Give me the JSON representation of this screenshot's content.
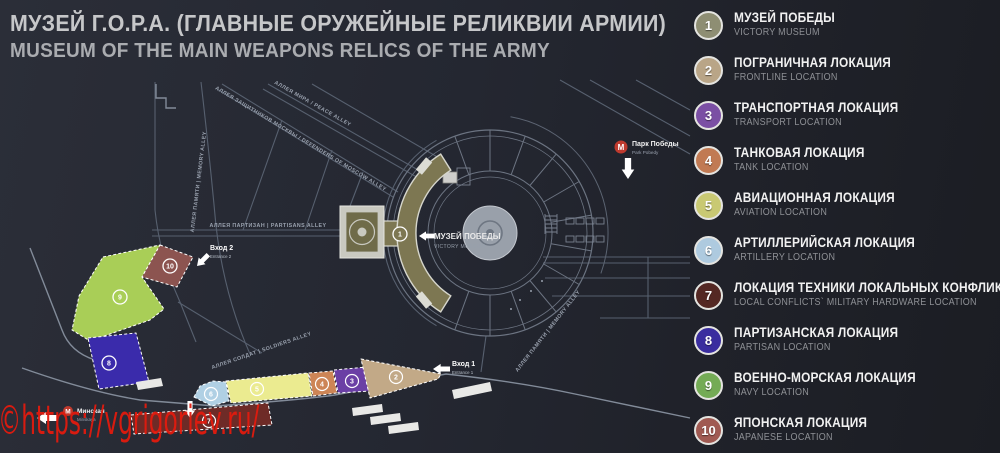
{
  "header": {
    "title_ru": "МУЗЕЙ Г.О.Р.А. (ГЛАВНЫЕ ОРУЖЕЙНЫЕ РЕЛИКВИИ АРМИИ)",
    "title_en": "MUSEUM OF THE MAIN WEAPONS RELICS OF THE ARMY"
  },
  "legend": {
    "items": [
      {
        "num": "1",
        "ru": "МУЗЕЙ ПОБЕДЫ",
        "en": "VICTORY MUSEUM",
        "color": "#8e8e73"
      },
      {
        "num": "2",
        "ru": "ПОГРАНИЧНАЯ ЛОКАЦИЯ",
        "en": "FRONTLINE LOCATION",
        "color": "#b9a587"
      },
      {
        "num": "3",
        "ru": "ТРАНСПОРТНАЯ ЛОКАЦИЯ",
        "en": "TRANSPORT LOCATION",
        "color": "#7b4fa4"
      },
      {
        "num": "4",
        "ru": "ТАНКОВАЯ ЛОКАЦИЯ",
        "en": "TANK LOCATION",
        "color": "#c17a53"
      },
      {
        "num": "5",
        "ru": "АВИАЦИОННАЯ ЛОКАЦИЯ",
        "en": "AVIATION LOCATION",
        "color": "#c9c973"
      },
      {
        "num": "6",
        "ru": "АРТИЛЛЕРИЙСКАЯ ЛОКАЦИЯ",
        "en": "ARTILLERY LOCATION",
        "color": "#aecadf"
      },
      {
        "num": "7",
        "ru": "ЛОКАЦИЯ ТЕХНИКИ ЛОКАЛЬНЫХ КОНФЛИКТОВ",
        "en": "LOCAL CONFLICTS` MILITARY HARDWARE LOCATION",
        "color": "#542823"
      },
      {
        "num": "8",
        "ru": "ПАРТИЗАНСКАЯ ЛОКАЦИЯ",
        "en": "PARTISAN LOCATION",
        "color": "#3a2d9f"
      },
      {
        "num": "9",
        "ru": "ВОЕННО-МОРСКАЯ ЛОКАЦИЯ",
        "en": "NAVY LOCATION",
        "color": "#74ab55"
      },
      {
        "num": "10",
        "ru": "ЯПОНСКАЯ ЛОКАЦИЯ",
        "en": "JAPANESE LOCATION",
        "color": "#a05a52"
      }
    ]
  },
  "map": {
    "museum_label": {
      "ru": "МУЗЕЙ ПОБЕДЫ",
      "en": "VICTORY MUSEUM"
    },
    "metro_park_pobedy": {
      "logo": "М",
      "ru": "Парк Победы",
      "en": "Park Pobedy"
    },
    "metro_minskaya": {
      "logo": "М",
      "ru": "Минская",
      "en": "Minskaya"
    },
    "entrance1": {
      "ru": "Вход 1",
      "en": "Entrance 1"
    },
    "entrance2": {
      "ru": "Вход 2",
      "en": "Entrance 2"
    },
    "streets": {
      "peace": "АЛЛЕЯ МИРА / PEACE ALLEY",
      "defenders": "АЛЛЕЯ ЗАЩИТНИКОВ МОСКВЫ / DEFENDERS OF MOSCOW ALLEY",
      "memory_west": "АЛЛЕЯ ПАМЯТИ | MEMORY ALLEY",
      "partisans": "АЛЛЕЯ ПАРТИЗАН | PARTISANS ALLEY",
      "soldiers": "АЛЛЕЯ СОЛДАТ | SOLDIERS ALLEY",
      "memory_se": "АЛЛЕЯ ПАМЯТИ | MEMORY ALLEY"
    },
    "zones": [
      {
        "num": "1",
        "color": "#7d7752"
      },
      {
        "num": "2",
        "color": "#c2a987"
      },
      {
        "num": "3",
        "color": "#6b3fa5"
      },
      {
        "num": "4",
        "color": "#cd8556"
      },
      {
        "num": "5",
        "color": "#ebeb90"
      },
      {
        "num": "6",
        "color": "#b0d0e4"
      },
      {
        "num": "7",
        "color": "#6e2b27"
      },
      {
        "num": "8",
        "color": "#3a2bab"
      },
      {
        "num": "9",
        "color": "#a9ce57"
      },
      {
        "num": "10",
        "color": "#8c5450"
      }
    ]
  },
  "watermark": {
    "text": "©https://vgrigoriev.ru/"
  }
}
